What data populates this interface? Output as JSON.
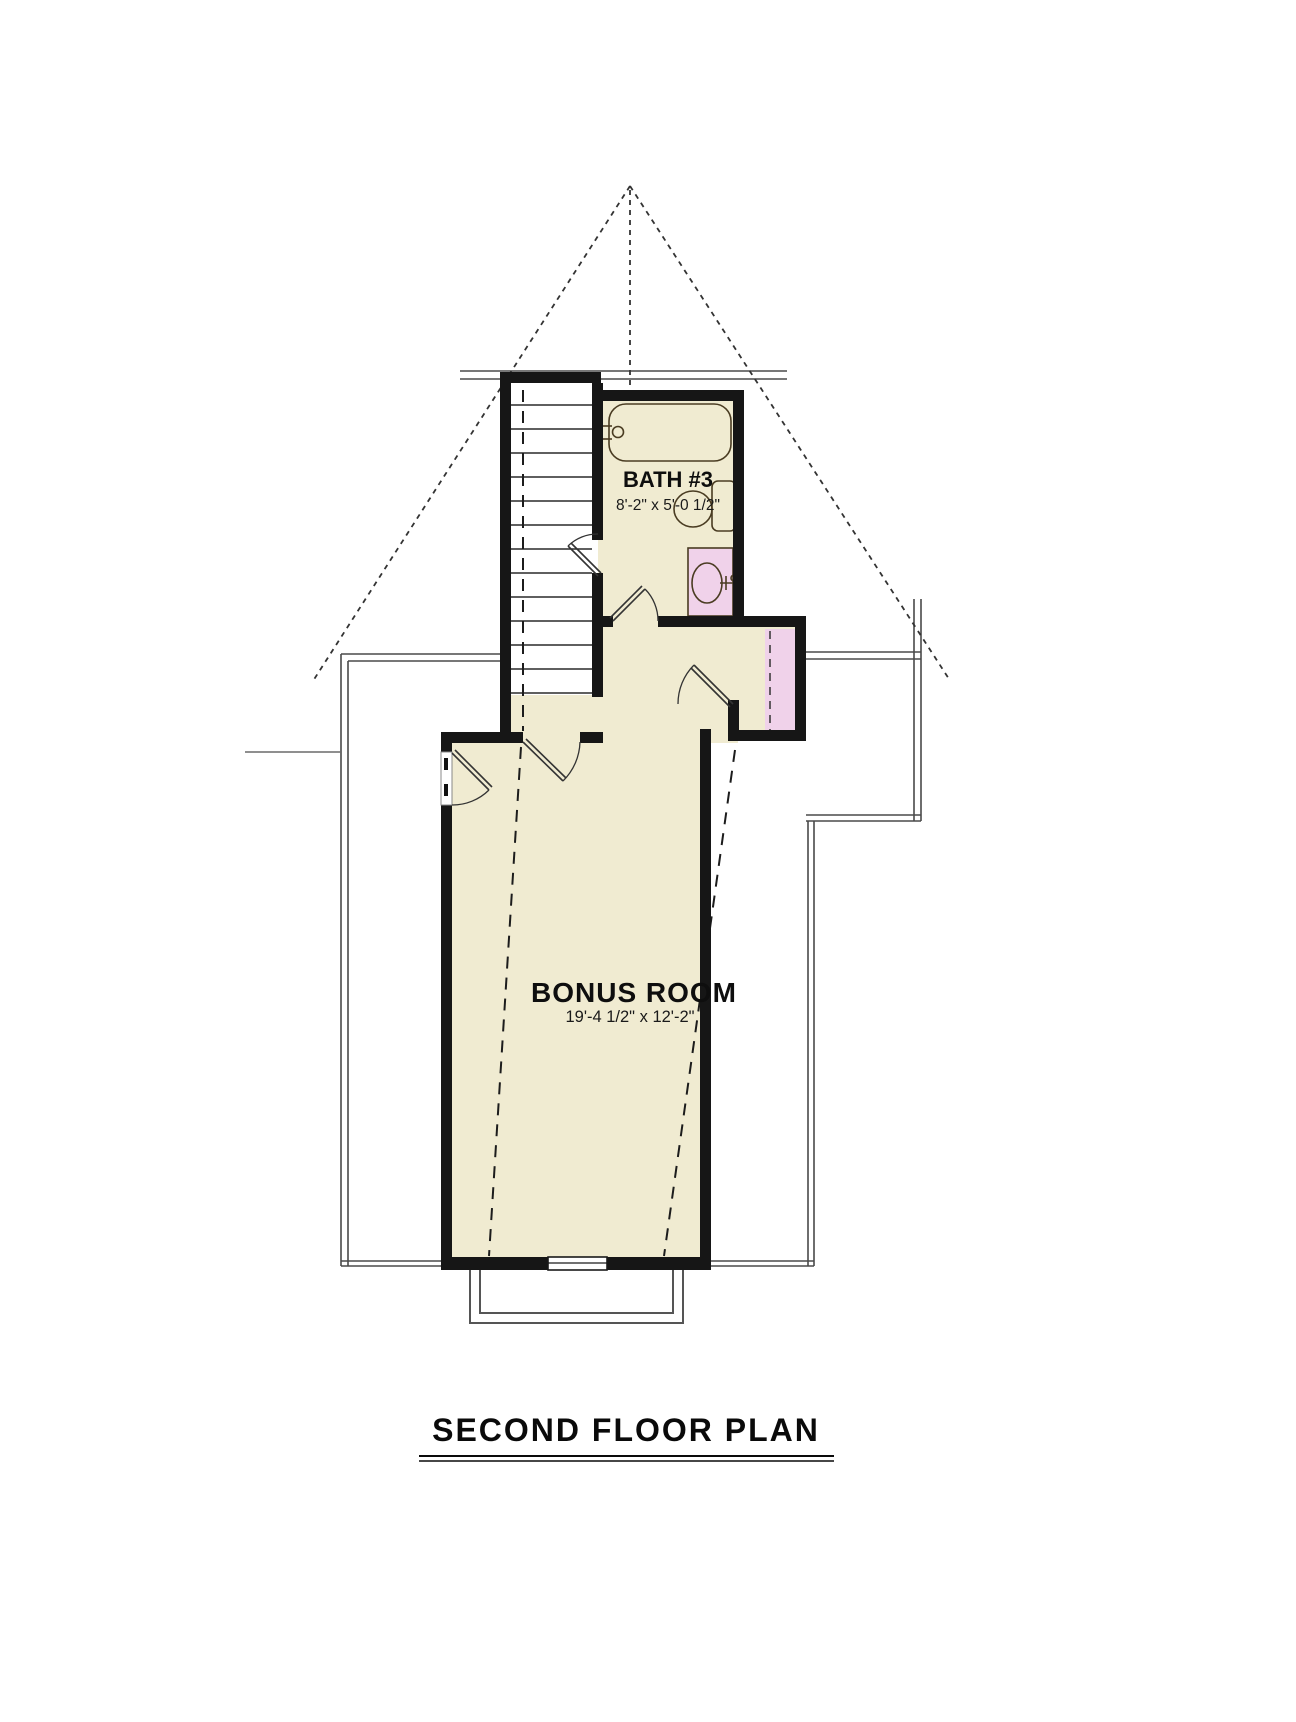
{
  "drawing_title": "SECOND FLOOR PLAN",
  "rooms": [
    {
      "name": "BATH #3",
      "dimensions": "8'-2\" x 5'-0 1/2\""
    },
    {
      "name": "BONUS ROOM",
      "dimensions": "19'-4 1/2\" x 12'-2\""
    }
  ],
  "fixtures": [
    "bathtub",
    "toilet",
    "sink-vanity",
    "closet-rod",
    "staircase",
    "window",
    "dormer"
  ],
  "colors": {
    "floor": "#f0ebd1",
    "accent_pink": "#f0d2ea",
    "wall": "#161616",
    "line": "#4a4a4a",
    "background": "#ffffff"
  }
}
